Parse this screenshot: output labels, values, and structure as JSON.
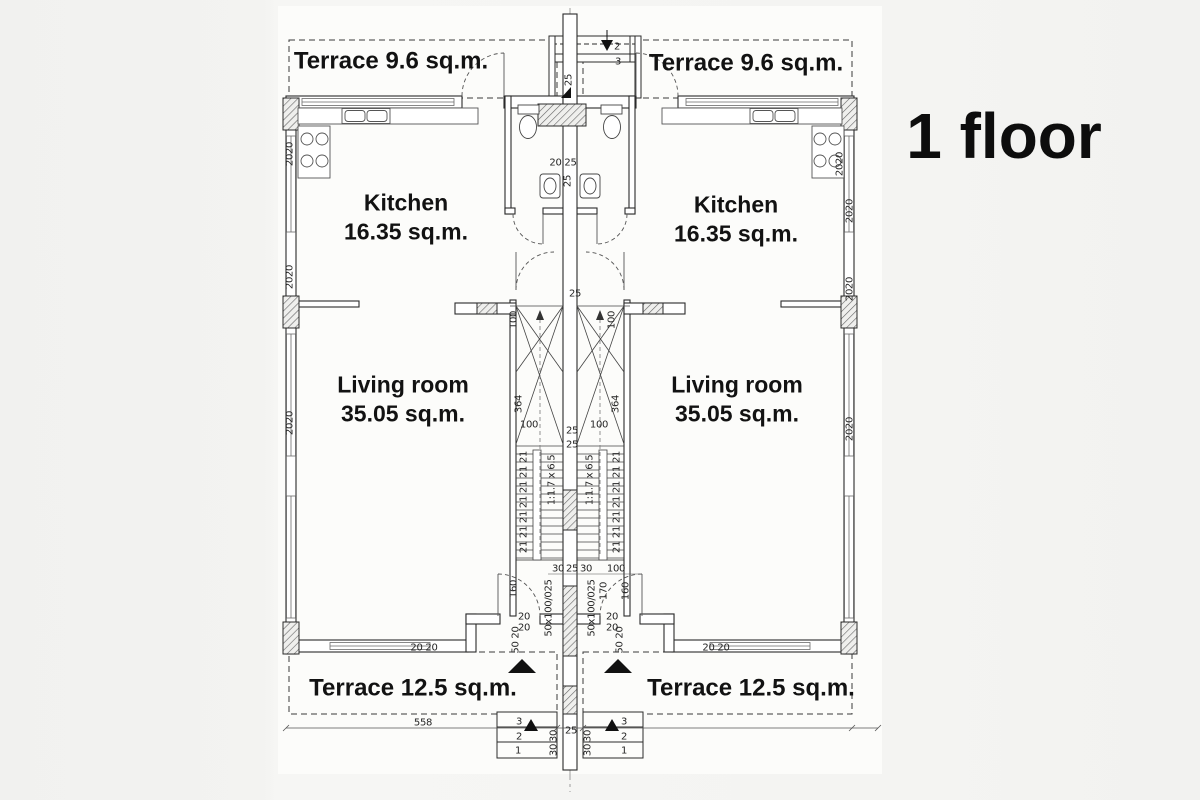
{
  "title": "1 floor",
  "colors": {
    "background": "#f3f3f1",
    "paper": "#fcfcfa",
    "line": "#2b2b2b",
    "text": "#121212",
    "dim_text": "#262626"
  },
  "room_labels": [
    {
      "id": "terrace-top-left",
      "lines": [
        "Terrace 9.6 sq.m."
      ],
      "x": 391,
      "y": 62,
      "fs": 24
    },
    {
      "id": "terrace-top-right",
      "lines": [
        "Terrace 9.6 sq.m."
      ],
      "x": 746,
      "y": 64,
      "fs": 24
    },
    {
      "id": "kitchen-left",
      "lines": [
        "Kitchen",
        "16.35 sq.m."
      ],
      "x": 406,
      "y": 218,
      "fs": 23
    },
    {
      "id": "kitchen-right",
      "lines": [
        "Kitchen",
        "16.35 sq.m."
      ],
      "x": 736,
      "y": 220,
      "fs": 23
    },
    {
      "id": "living-room-left",
      "lines": [
        "Living room",
        "35.05 sq.m."
      ],
      "x": 403,
      "y": 400,
      "fs": 23
    },
    {
      "id": "living-room-right",
      "lines": [
        "Living room",
        "35.05 sq.m."
      ],
      "x": 737,
      "y": 400,
      "fs": 23
    },
    {
      "id": "terrace-bottom-left",
      "lines": [
        "Terrace 12.5 sq.m."
      ],
      "x": 413,
      "y": 689,
      "fs": 24
    },
    {
      "id": "terrace-bottom-right",
      "lines": [
        "Terrace 12.5 sq.m."
      ],
      "x": 751,
      "y": 689,
      "fs": 24
    }
  ],
  "dimension_labels": [
    {
      "t": "2",
      "x": 617,
      "y": 47
    },
    {
      "t": "3",
      "x": 618,
      "y": 62
    },
    {
      "t": "25",
      "x": 569,
      "y": 80,
      "r": -90
    },
    {
      "t": "20 25",
      "x": 563,
      "y": 163
    },
    {
      "t": "25",
      "x": 568,
      "y": 181,
      "r": -90
    },
    {
      "t": "20",
      "x": 290,
      "y": 148,
      "r": -90
    },
    {
      "t": "20",
      "x": 290,
      "y": 160,
      "r": -90
    },
    {
      "t": "20",
      "x": 290,
      "y": 271,
      "r": -90
    },
    {
      "t": "20",
      "x": 290,
      "y": 283,
      "r": -90
    },
    {
      "t": "20",
      "x": 290,
      "y": 417,
      "r": -90
    },
    {
      "t": "20",
      "x": 290,
      "y": 429,
      "r": -90
    },
    {
      "t": "20",
      "x": 840,
      "y": 158,
      "r": -90
    },
    {
      "t": "20",
      "x": 840,
      "y": 170,
      "r": -90
    },
    {
      "t": "20",
      "x": 850,
      "y": 205,
      "r": -90
    },
    {
      "t": "20",
      "x": 850,
      "y": 217,
      "r": -90
    },
    {
      "t": "20",
      "x": 850,
      "y": 283,
      "r": -90
    },
    {
      "t": "20",
      "x": 850,
      "y": 295,
      "r": -90
    },
    {
      "t": "20",
      "x": 850,
      "y": 423,
      "r": -90
    },
    {
      "t": "20",
      "x": 850,
      "y": 435,
      "r": -90
    },
    {
      "t": "25",
      "x": 575,
      "y": 294
    },
    {
      "t": "100",
      "x": 514,
      "y": 320,
      "r": -90
    },
    {
      "t": "100",
      "x": 612,
      "y": 320,
      "r": -90
    },
    {
      "t": "364",
      "x": 519,
      "y": 404,
      "r": -90
    },
    {
      "t": "364",
      "x": 616,
      "y": 404,
      "r": -90
    },
    {
      "t": "100",
      "x": 529,
      "y": 425
    },
    {
      "t": "100",
      "x": 599,
      "y": 425
    },
    {
      "t": "25",
      "x": 572,
      "y": 431
    },
    {
      "t": "25",
      "x": 572,
      "y": 445
    },
    {
      "t": "21 21 21 21 21 21 21",
      "x": 524,
      "y": 502,
      "r": -90
    },
    {
      "t": "21 21 21 21 21 21 21",
      "x": 617,
      "y": 502,
      "r": -90
    },
    {
      "t": "1:1.7 x 6.5",
      "x": 552,
      "y": 480,
      "r": -90
    },
    {
      "t": "1:1.7 x 6.5",
      "x": 590,
      "y": 480,
      "r": -90
    },
    {
      "t": "30",
      "x": 558,
      "y": 569
    },
    {
      "t": "25",
      "x": 572,
      "y": 569
    },
    {
      "t": "30",
      "x": 586,
      "y": 569
    },
    {
      "t": "100",
      "x": 616,
      "y": 569
    },
    {
      "t": "160",
      "x": 514,
      "y": 589,
      "r": -90
    },
    {
      "t": "170",
      "x": 604,
      "y": 591,
      "r": -90
    },
    {
      "t": "160",
      "x": 626,
      "y": 591,
      "r": -90
    },
    {
      "t": "20",
      "x": 524,
      "y": 617
    },
    {
      "t": "20",
      "x": 524,
      "y": 628
    },
    {
      "t": "20",
      "x": 612,
      "y": 617
    },
    {
      "t": "20",
      "x": 612,
      "y": 628
    },
    {
      "t": "50 20",
      "x": 516,
      "y": 640,
      "r": -90
    },
    {
      "t": "50 20",
      "x": 620,
      "y": 640,
      "r": -90
    },
    {
      "t": "50x100/025",
      "x": 549,
      "y": 608,
      "r": -90
    },
    {
      "t": "50x100/025",
      "x": 592,
      "y": 608,
      "r": -90
    },
    {
      "t": "20 20",
      "x": 424,
      "y": 648
    },
    {
      "t": "20 20",
      "x": 716,
      "y": 648
    },
    {
      "t": "558",
      "x": 423,
      "y": 723
    },
    {
      "t": "25",
      "x": 571,
      "y": 731
    },
    {
      "t": "3",
      "x": 519,
      "y": 722
    },
    {
      "t": "2",
      "x": 519,
      "y": 737
    },
    {
      "t": "1",
      "x": 518,
      "y": 751
    },
    {
      "t": "3",
      "x": 624,
      "y": 722
    },
    {
      "t": "2",
      "x": 624,
      "y": 737
    },
    {
      "t": "1",
      "x": 624,
      "y": 751
    },
    {
      "t": "30",
      "x": 554,
      "y": 736,
      "r": -90
    },
    {
      "t": "30",
      "x": 554,
      "y": 750,
      "r": -90
    },
    {
      "t": "30",
      "x": 588,
      "y": 736,
      "r": -90
    },
    {
      "t": "30",
      "x": 588,
      "y": 750,
      "r": -90
    }
  ]
}
